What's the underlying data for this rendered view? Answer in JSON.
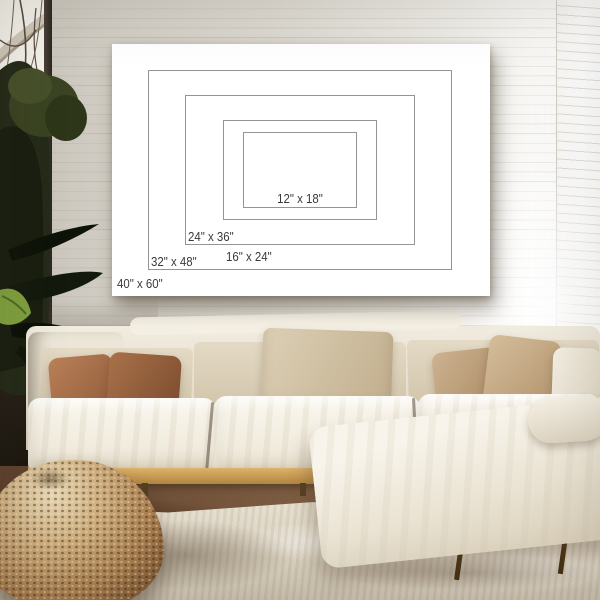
{
  "poster": {
    "sizes": [
      "40\" x 60\"",
      "32\" x 48\"",
      "24\" x 36\"",
      "16\" x 24\"",
      "12\" x 18\""
    ]
  },
  "colors": {
    "poster_bg": "#ffffff",
    "rect_border": "#949494",
    "label_text": "#3a3a3a",
    "wall": "#d8d4cb",
    "sofa_fabric": "#f2ede2",
    "back_cushion": "#d8cbb0",
    "pillow_brown": "#9c6844",
    "pillow_tan": "#c8ae8c",
    "wood_base": "#c59a55",
    "pouf": "#a57e50",
    "rug": "#d9d1c0",
    "floor": "#74543b",
    "foliage": "#232a19"
  }
}
